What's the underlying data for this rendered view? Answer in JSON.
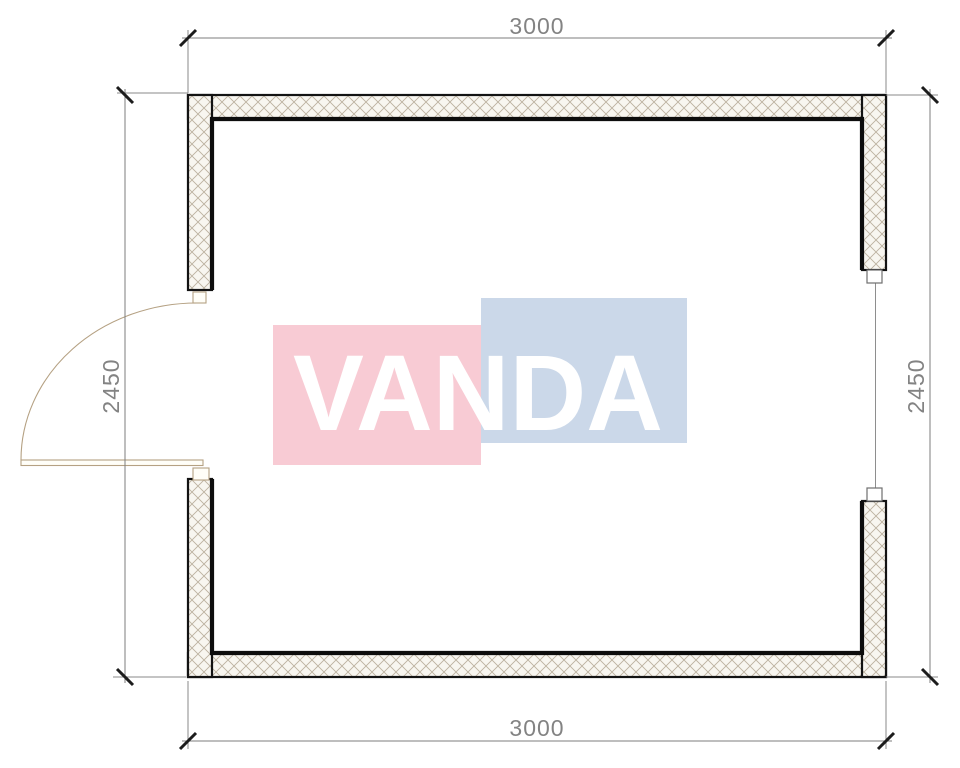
{
  "watermark": {
    "text": "VANDA",
    "pink_color": "#f8cbd4",
    "blue_color": "#cbd8e9",
    "text_color": "#ffffff"
  },
  "dimensions": {
    "top": {
      "label": "3000"
    },
    "bottom": {
      "label": "3000"
    },
    "left": {
      "label": "2450"
    },
    "right": {
      "label": "2450"
    }
  },
  "style": {
    "dimension_color": "#838383",
    "wall_line_color": "#131313",
    "hatch_line_color": "#bcb2a0",
    "wall_fill_color": "#f8f6f0",
    "door_color": "#b5a183"
  }
}
